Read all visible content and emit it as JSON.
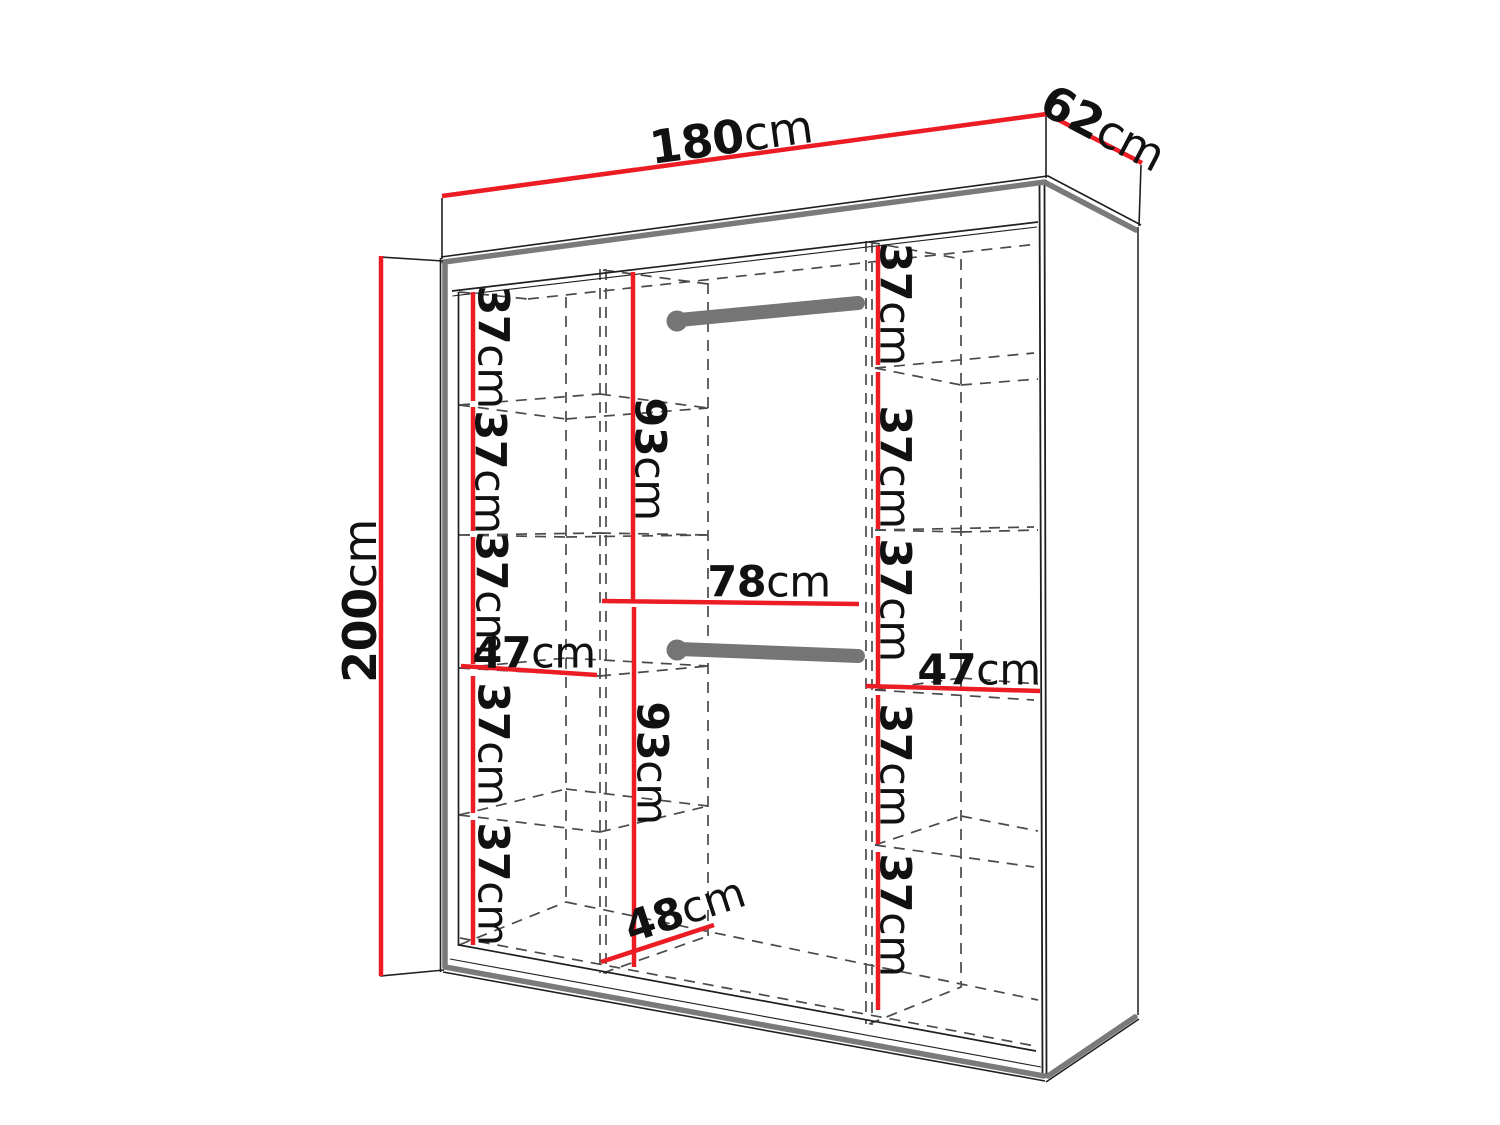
{
  "page": {
    "title": "Wardrobe interior dimensions diagram",
    "background": "#ffffff"
  },
  "colors": {
    "dimension_line": "#EC1C24",
    "cabinet_outline_heavy": "#7A7A7A",
    "cabinet_outline_thin": "#1F1F1F",
    "hidden_dashed_line": "#4A4A4A",
    "hanging_rail": "#757575",
    "label_text": "#111111",
    "background": "#ffffff"
  },
  "dimensions": {
    "overall": {
      "width": {
        "value": "180",
        "unit": "cm"
      },
      "depth": {
        "value": "62",
        "unit": "cm"
      },
      "height": {
        "value": "200",
        "unit": "cm"
      }
    },
    "left_column": {
      "section_width": {
        "value": "47",
        "unit": "cm"
      },
      "shelf_spacings": [
        {
          "value": "37",
          "unit": "cm"
        },
        {
          "value": "37",
          "unit": "cm"
        },
        {
          "value": "37",
          "unit": "cm"
        },
        {
          "value": "37",
          "unit": "cm"
        },
        {
          "value": "37",
          "unit": "cm"
        }
      ]
    },
    "center_section": {
      "upper_hanging_height": {
        "value": "93",
        "unit": "cm"
      },
      "hanging_rail_width": {
        "value": "78",
        "unit": "cm"
      },
      "lower_hanging_height": {
        "value": "93",
        "unit": "cm"
      },
      "base_depth": {
        "value": "48",
        "unit": "cm"
      }
    },
    "right_column": {
      "section_width": {
        "value": "47",
        "unit": "cm"
      },
      "shelf_spacings": [
        {
          "value": "37",
          "unit": "cm"
        },
        {
          "value": "37",
          "unit": "cm"
        },
        {
          "value": "37",
          "unit": "cm"
        },
        {
          "value": "37",
          "unit": "cm"
        },
        {
          "value": "37",
          "unit": "cm"
        }
      ]
    }
  }
}
